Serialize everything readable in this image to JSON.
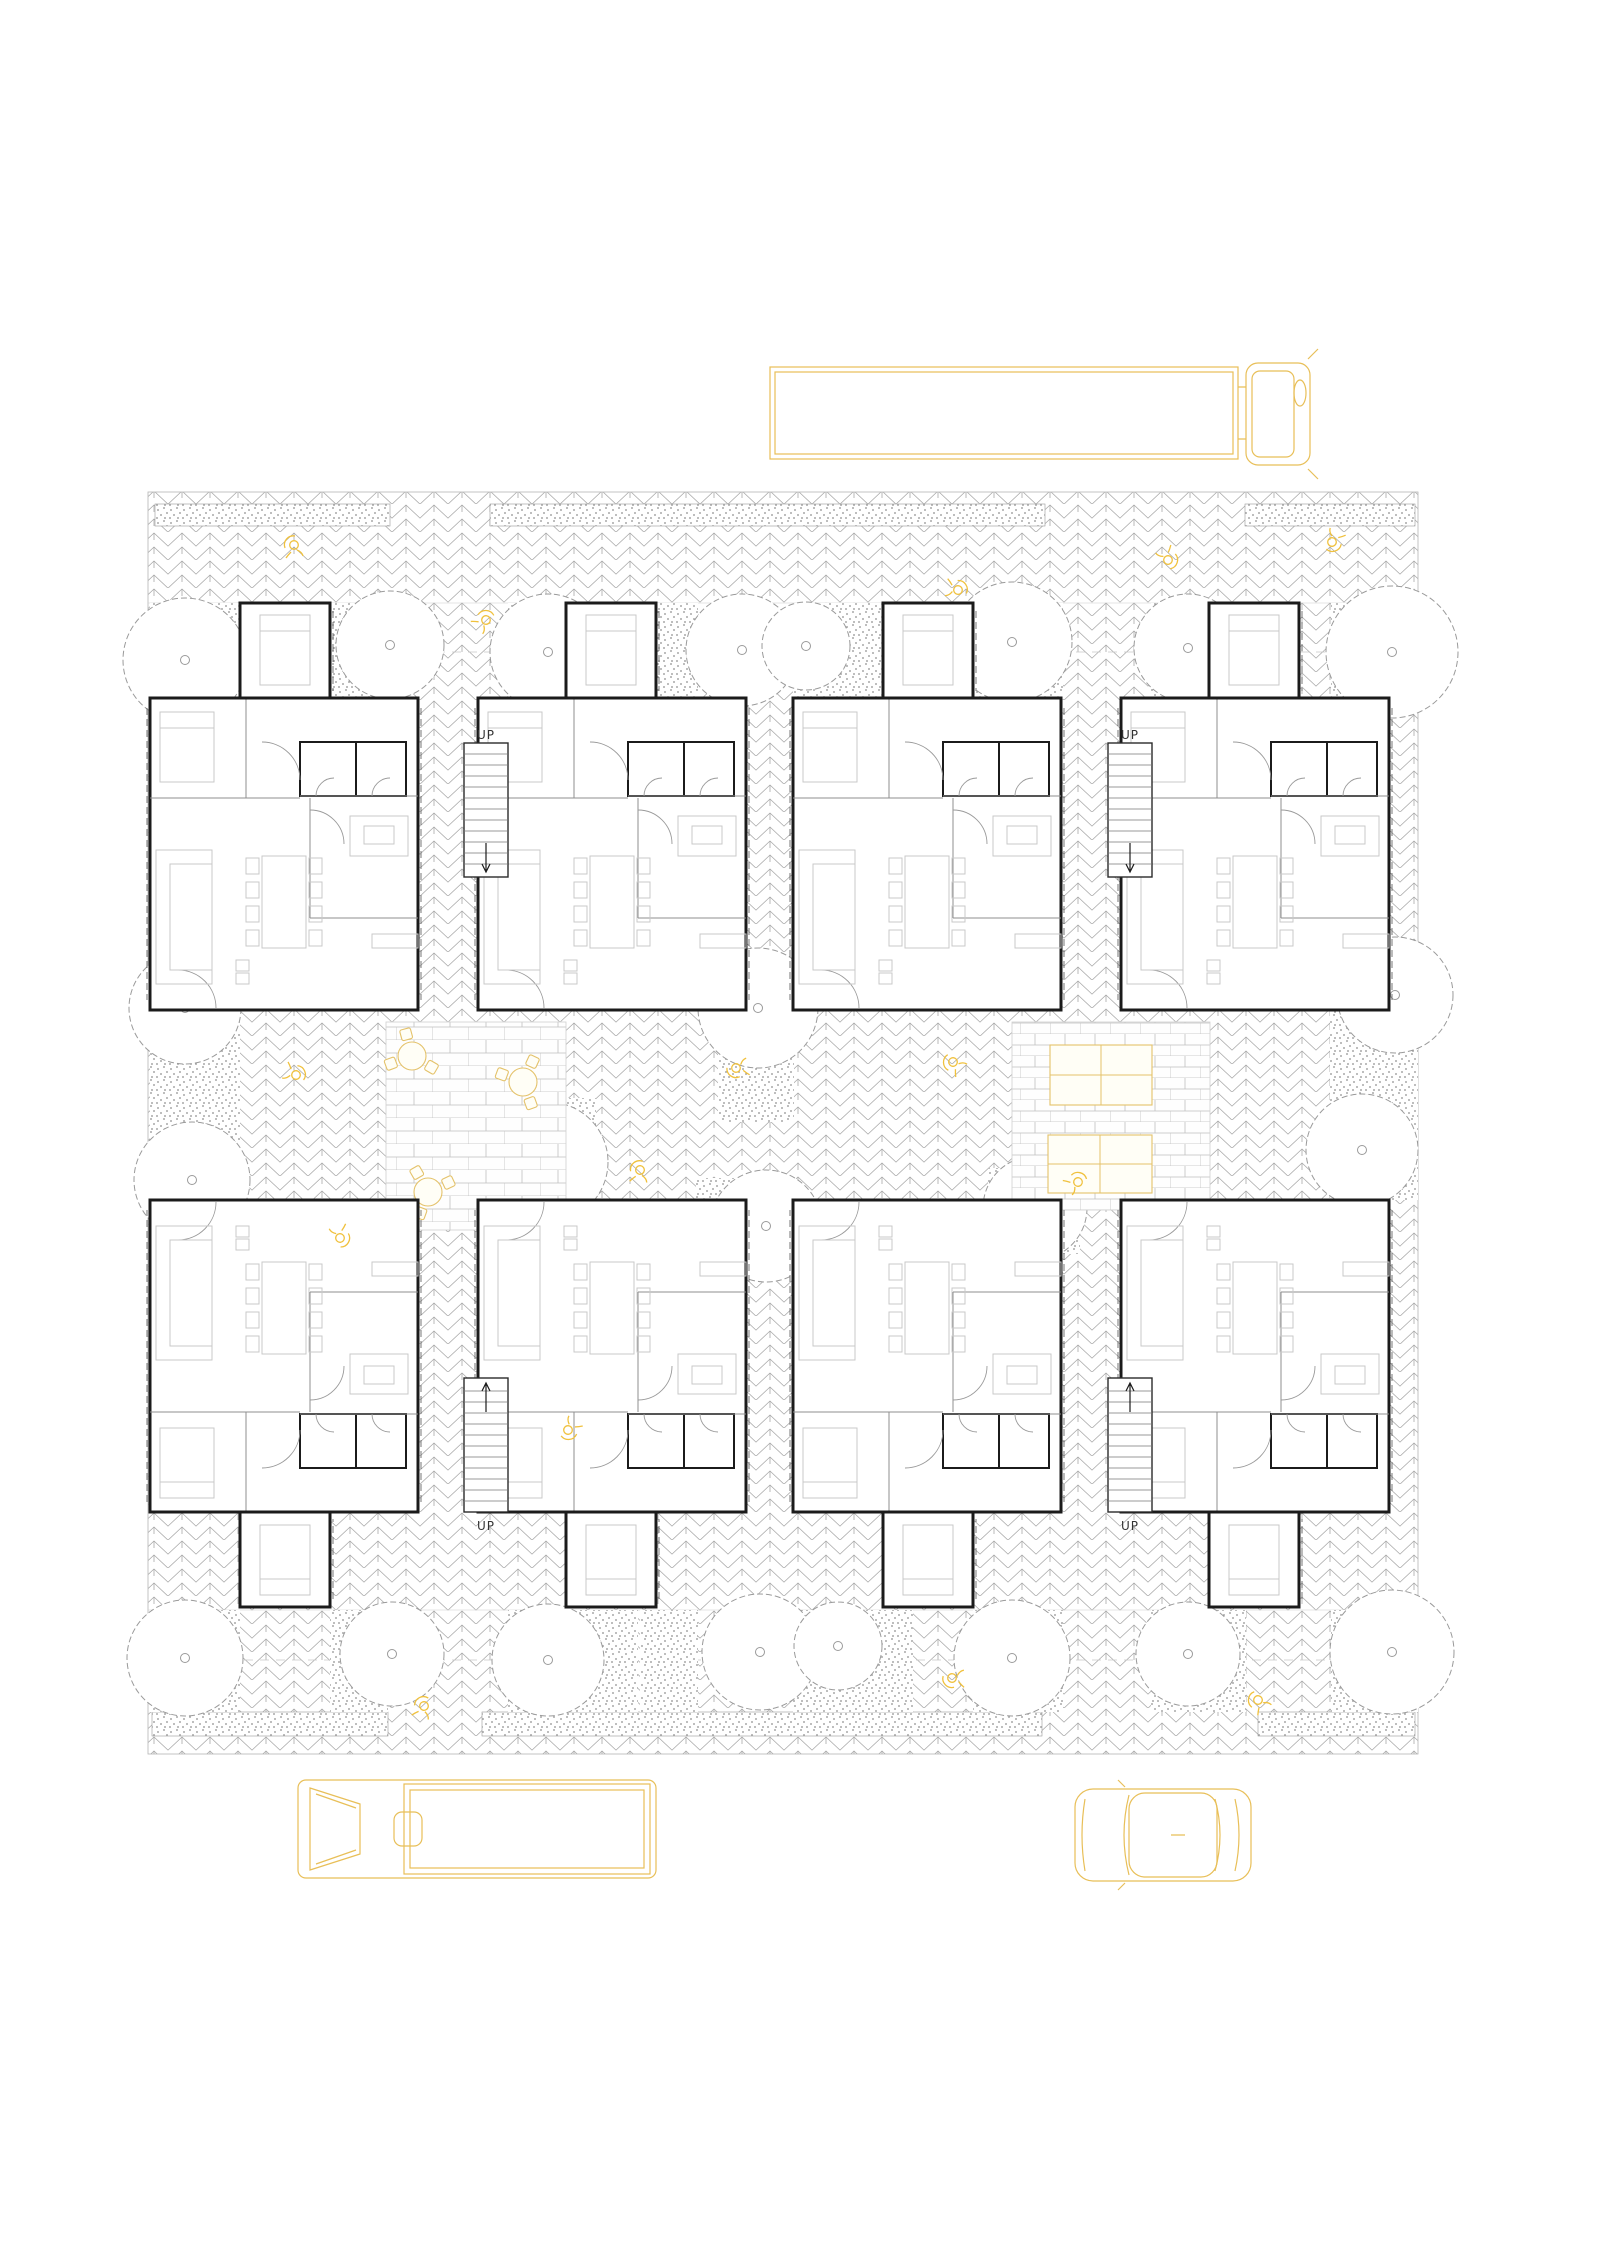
{
  "page": {
    "width": 1600,
    "height": 2262,
    "background": "#ffffff"
  },
  "drawing": {
    "type": "architectural-site-plan",
    "description": "Ground floor plan: eight mirrored dwellings in two rows around two paved courtyards, herringbone street paving, stippled gardens with trees, yellow vehicles and people",
    "labels": {
      "stair_up": "UP"
    },
    "colors": {
      "wall": "#1b1b1b",
      "partition": "#8f8f8f",
      "furniture": "#c9c9c9",
      "paving": "#a8a8a8",
      "stipple": "#8f8f8f",
      "brick": "#c0c0c0",
      "treeline": "#9a9a9a",
      "vehicle": "#e8bf58",
      "figure": "#f0c13d",
      "courtfur": "#e4c26a",
      "label": "#333333",
      "edge": "#b5b5b5"
    },
    "plan_area": {
      "x": 148,
      "y": 492,
      "w": 1270,
      "h": 1262
    },
    "garden_boundaries": [
      603,
      652,
      1610,
      1660
    ],
    "sidewalk_strips": {
      "top": {
        "y": 504,
        "h": 22,
        "segments": [
          [
            155,
            235
          ],
          [
            490,
            555
          ],
          [
            1245,
            170
          ]
        ]
      },
      "bottom": {
        "y": 1712,
        "h": 24,
        "segments": [
          [
            152,
            236
          ],
          [
            482,
            560
          ],
          [
            1258,
            157
          ]
        ]
      }
    },
    "gardens": {
      "top_band": {
        "y": 603,
        "h": 97,
        "segments": [
          [
            150,
            90
          ],
          [
            330,
            58
          ],
          [
            508,
            130
          ],
          [
            640,
            58
          ],
          [
            793,
            120
          ],
          [
            973,
            90
          ],
          [
            1151,
            95
          ],
          [
            1331,
            87
          ]
        ]
      },
      "mid_patches": [
        [
          150,
          1010,
          90,
          200
        ],
        [
          500,
          1098,
          96,
          128
        ],
        [
          718,
          1012,
          76,
          110
        ],
        [
          696,
          1178,
          96,
          96
        ],
        [
          988,
          1168,
          92,
          86
        ],
        [
          1330,
          1010,
          88,
          190
        ]
      ],
      "bottom_band": {
        "y": 1610,
        "h": 102,
        "segments": [
          [
            150,
            90
          ],
          [
            330,
            58
          ],
          [
            508,
            130
          ],
          [
            640,
            58
          ],
          [
            793,
            120
          ],
          [
            973,
            90
          ],
          [
            1151,
            95
          ],
          [
            1331,
            87
          ]
        ]
      }
    },
    "units": {
      "body_w": 268,
      "body_h": 312,
      "bodies_x": [
        150,
        478,
        793,
        1121
      ],
      "prot_w": 90,
      "prot_h": 95,
      "prots_x": [
        240,
        566,
        883,
        1209
      ],
      "stair_w": 44,
      "stair_h": 134,
      "stairs_x": [
        464,
        1108
      ],
      "rows": {
        "upper": {
          "body_y": 698,
          "prot_y": 603,
          "stair_y": 743,
          "label_y": 739
        },
        "lower": {
          "body_y": 1200,
          "prot_y": 1512,
          "stair_y": 1378,
          "label_y": 1530
        }
      }
    },
    "courtyards": [
      {
        "id": "west-courtyard",
        "x": 386,
        "y": 1022,
        "w": 180,
        "h": 208,
        "pattern": "running-bond",
        "round_tables": [
          [
            412,
            1056
          ],
          [
            523,
            1082
          ],
          [
            428,
            1192
          ]
        ]
      },
      {
        "id": "east-courtyard",
        "x": 1012,
        "y": 1022,
        "w": 198,
        "h": 188,
        "pattern": "grid-bond",
        "rect_tables": [
          [
            1050,
            1045,
            102,
            60
          ],
          [
            1048,
            1135,
            104,
            58
          ]
        ]
      }
    ],
    "trees": [
      [
        185,
        660,
        62
      ],
      [
        390,
        645,
        54
      ],
      [
        548,
        652,
        58
      ],
      [
        742,
        650,
        56
      ],
      [
        806,
        646,
        44
      ],
      [
        1012,
        642,
        60
      ],
      [
        1188,
        648,
        54
      ],
      [
        1392,
        652,
        66
      ],
      [
        185,
        1008,
        56
      ],
      [
        758,
        1008,
        60
      ],
      [
        1395,
        995,
        58
      ],
      [
        192,
        1180,
        58
      ],
      [
        548,
        1162,
        60
      ],
      [
        766,
        1226,
        56
      ],
      [
        1035,
        1208,
        52
      ],
      [
        1362,
        1150,
        56
      ],
      [
        185,
        1658,
        58
      ],
      [
        392,
        1654,
        52
      ],
      [
        548,
        1660,
        56
      ],
      [
        760,
        1652,
        58
      ],
      [
        838,
        1646,
        44
      ],
      [
        1012,
        1658,
        58
      ],
      [
        1188,
        1654,
        52
      ],
      [
        1392,
        1652,
        62
      ]
    ],
    "figures": [
      [
        294,
        545
      ],
      [
        486,
        620
      ],
      [
        958,
        590
      ],
      [
        1168,
        560
      ],
      [
        1332,
        542
      ],
      [
        736,
        1068
      ],
      [
        953,
        1062
      ],
      [
        640,
        1170
      ],
      [
        1078,
        1182
      ],
      [
        296,
        1075
      ],
      [
        340,
        1238
      ],
      [
        568,
        1430
      ],
      [
        952,
        1678
      ],
      [
        1258,
        1700
      ],
      [
        424,
        1706
      ]
    ],
    "vehicles": [
      {
        "type": "trailer-truck",
        "x": 770,
        "y": 363
      },
      {
        "type": "box-truck",
        "x": 298,
        "y": 1780
      },
      {
        "type": "car",
        "x": 1075,
        "y": 1785
      }
    ]
  }
}
